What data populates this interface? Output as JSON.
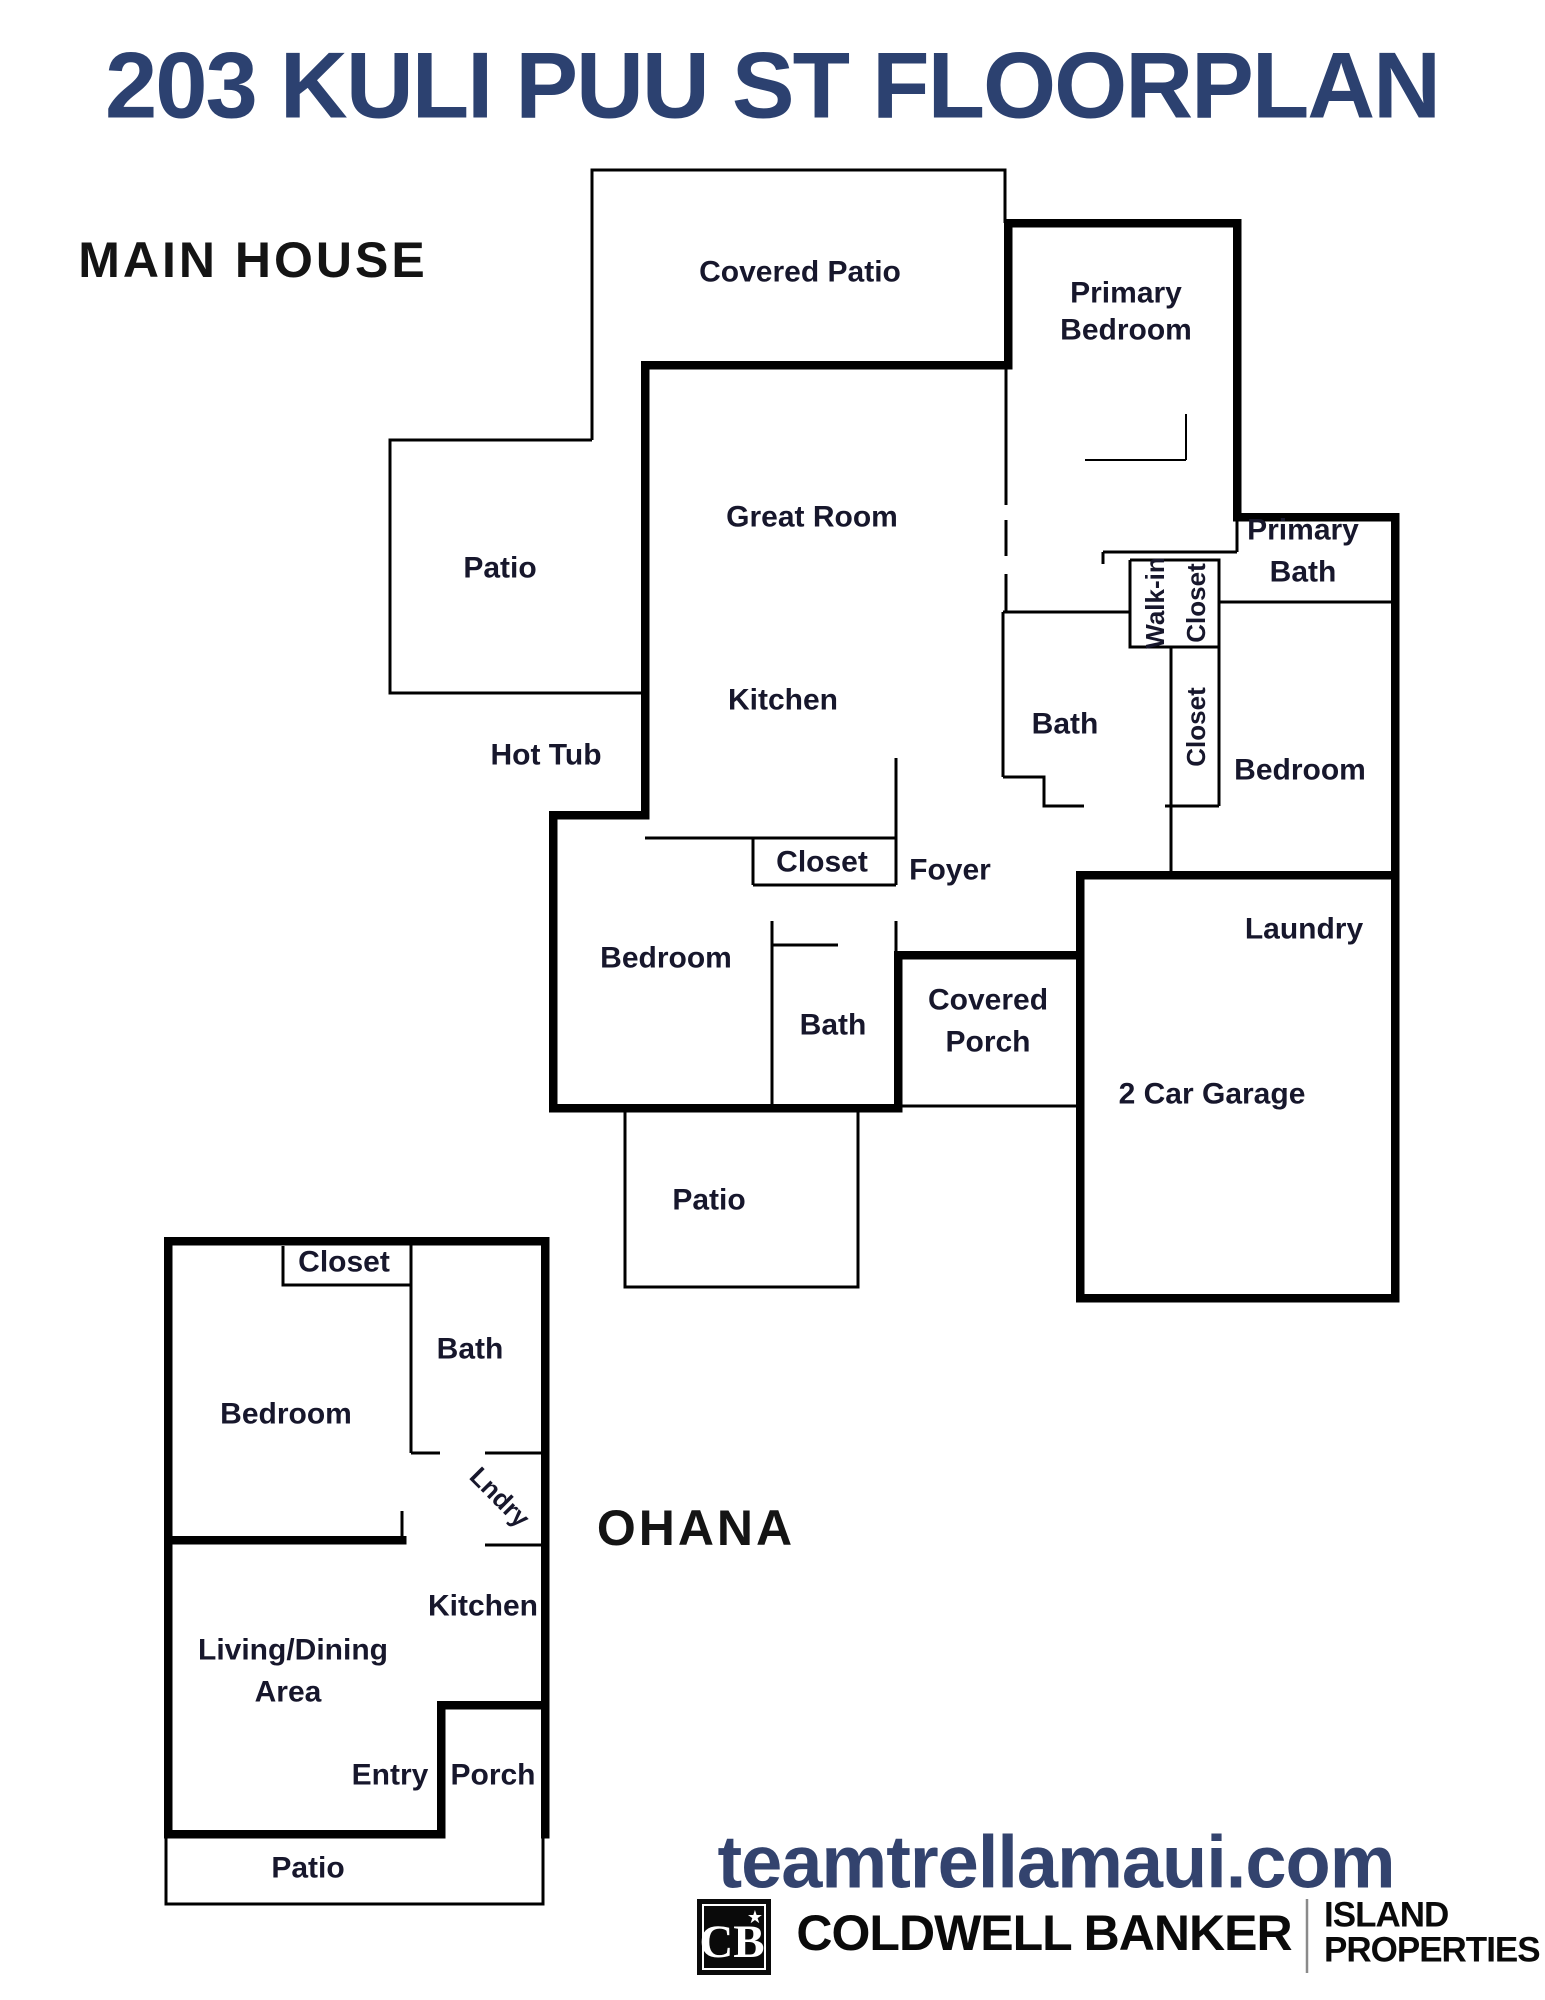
{
  "page": {
    "title": "203 KULI PUU ST FLOORPLAN"
  },
  "main_house": {
    "section_label": "MAIN HOUSE",
    "labels": {
      "covered_patio": "Covered Patio",
      "patio_upper": "Patio",
      "great_room": "Great Room",
      "kitchen": "Kitchen",
      "hot_tub": "Hot Tub",
      "hall_closet": "Closet",
      "foyer": "Foyer",
      "bedroom_front": "Bedroom",
      "bath_front": "Bath",
      "covered_porch_line1": "Covered",
      "covered_porch_line2": "Porch",
      "primary_bedroom_line1": "Primary",
      "primary_bedroom_line2": "Bedroom",
      "primary_bath_line1": "Primary",
      "primary_bath_line2": "Bath",
      "walk_in_closet_line1": "Walk-in",
      "walk_in_closet_line2": "Closet",
      "hall_bath": "Bath",
      "bedroom_closet": "Closet",
      "bedroom_back": "Bedroom",
      "laundry": "Laundry",
      "garage": "2 Car Garage",
      "patio_lower": "Patio"
    }
  },
  "ohana": {
    "section_label": "OHANA",
    "labels": {
      "closet": "Closet",
      "bath": "Bath",
      "bedroom": "Bedroom",
      "laundry": "Lndry",
      "kitchen": "Kitchen",
      "living_dining_line1": "Living/Dining",
      "living_dining_line2": "Area",
      "entry": "Entry",
      "porch": "Porch",
      "patio": "Patio"
    }
  },
  "footer": {
    "website": "teamtrellamaui.com",
    "brand": "COLDWELL BANKER",
    "brand_monogram": "CB",
    "brand_star": "★",
    "division_line1": "ISLAND",
    "division_line2": "PROPERTIES"
  },
  "colors": {
    "title_navy": "#2c4170",
    "website_navy": "#33436e",
    "wall_black": "#000000",
    "room_label": "#17172c"
  }
}
